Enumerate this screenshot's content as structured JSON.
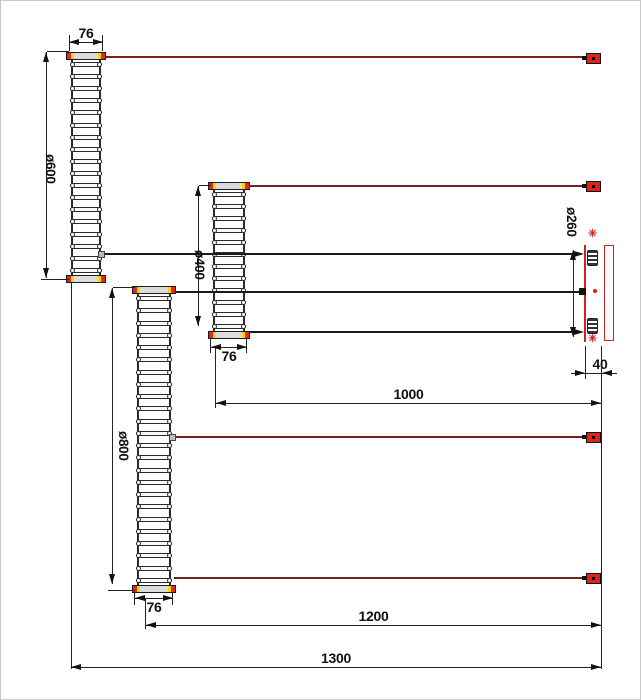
{
  "drawing": {
    "type": "engineering-drawing",
    "description": "Three concentric finned heating-element coils (shown developed) wired to a right-hand terminal block with four lead plugs",
    "dimensions": {
      "coil600_width": "76",
      "coil600_diameter": "ø600",
      "coil400_diameter": "ø400",
      "coil400_width": "76",
      "coil800_diameter": "ø800",
      "coil800_width": "76",
      "terminal_diameter": "ø260",
      "terminal_width": "40",
      "length_1000": "1000",
      "length_1200": "1200",
      "length_1300": "1300"
    },
    "colors": {
      "line": "#222222",
      "wire_red": "#7a1f1f",
      "plug_red": "#e02318",
      "terminal_red": "#d42020",
      "cap_yellow": "#ffd400"
    },
    "icons": {
      "terminal_screw": "✳"
    }
  }
}
